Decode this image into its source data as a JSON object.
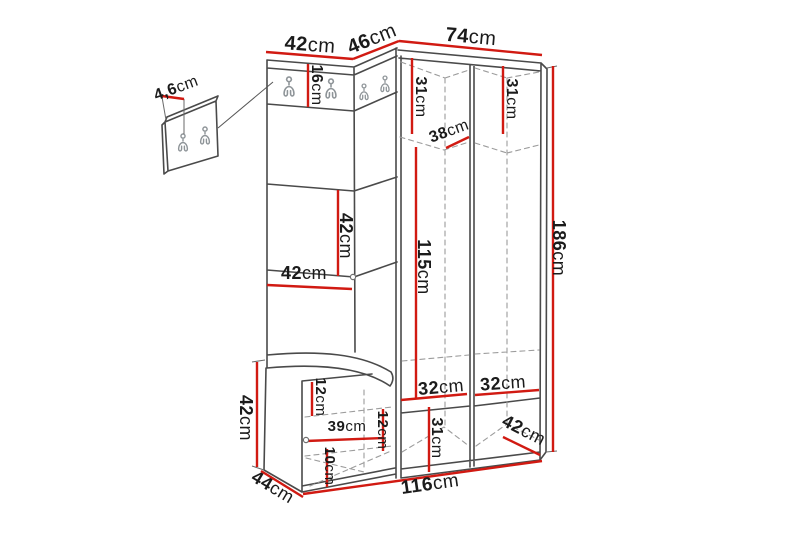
{
  "diagram": {
    "description": "Corner hallway furniture set dimension drawing with wall hook panel detail",
    "unit": "cm",
    "colors": {
      "dimension_line": "#d11a12",
      "outline": "#4a4a4a",
      "dashed": "#9c9c9c",
      "label_text": "#1b1b1b",
      "hook": "#8e9498",
      "background": "#ffffff"
    },
    "dimensions": [
      {
        "id": "top-width-left-section",
        "value": "42",
        "unit": "cm",
        "x": 310,
        "y": 45,
        "rot": 4,
        "size": 20
      },
      {
        "id": "top-width-corner-section",
        "value": "46",
        "unit": "cm",
        "x": 372,
        "y": 39,
        "rot": -22,
        "size": 20
      },
      {
        "id": "top-width-wardrobe",
        "value": "74",
        "unit": "cm",
        "x": 471,
        "y": 37,
        "rot": 5,
        "size": 20
      },
      {
        "id": "hook-panel-depth",
        "value": "4,6",
        "unit": "cm",
        "x": 176,
        "y": 88,
        "rot": -20,
        "size": 16
      },
      {
        "id": "hook-strip-height",
        "value": "16",
        "unit": "cm",
        "x": 317,
        "y": 85,
        "rot": 90,
        "size": 16
      },
      {
        "id": "top-shelf-depth-left",
        "value": "31",
        "unit": "cm",
        "x": 421,
        "y": 97,
        "rot": 90,
        "size": 16
      },
      {
        "id": "top-shelf-depth-right",
        "value": "31",
        "unit": "cm",
        "x": 512,
        "y": 99,
        "rot": 90,
        "size": 16
      },
      {
        "id": "top-shelf-width",
        "value": "38",
        "unit": "cm",
        "x": 449,
        "y": 131,
        "rot": -20,
        "size": 16
      },
      {
        "id": "hanging-space-height",
        "value": "115",
        "unit": "cm",
        "x": 424,
        "y": 267,
        "rot": 90,
        "size": 18
      },
      {
        "id": "open-shelf-section-height",
        "value": "42",
        "unit": "cm",
        "x": 346,
        "y": 236,
        "rot": 90,
        "size": 18
      },
      {
        "id": "open-shelf-width",
        "value": "42",
        "unit": "cm",
        "x": 304,
        "y": 273,
        "rot": 0,
        "size": 18
      },
      {
        "id": "bench-height",
        "value": "42",
        "unit": "cm",
        "x": 246,
        "y": 418,
        "rot": 90,
        "size": 18
      },
      {
        "id": "bench-depth",
        "value": "44",
        "unit": "cm",
        "x": 273,
        "y": 487,
        "rot": 31,
        "size": 18
      },
      {
        "id": "bench-top-section-height",
        "value": "12",
        "unit": "cm",
        "x": 321,
        "y": 397,
        "rot": 90,
        "size": 15
      },
      {
        "id": "bench-inner-width",
        "value": "39",
        "unit": "cm",
        "x": 347,
        "y": 426,
        "rot": 0,
        "size": 15
      },
      {
        "id": "bench-right-section-height",
        "value": "12",
        "unit": "cm",
        "x": 383,
        "y": 430,
        "rot": 90,
        "size": 15
      },
      {
        "id": "bench-bottom-section-height",
        "value": "10",
        "unit": "cm",
        "x": 330,
        "y": 466,
        "rot": 90,
        "size": 15
      },
      {
        "id": "wardrobe-inner-width-left",
        "value": "32",
        "unit": "cm",
        "x": 441,
        "y": 387,
        "rot": -5,
        "size": 18
      },
      {
        "id": "wardrobe-inner-width-right",
        "value": "32",
        "unit": "cm",
        "x": 503,
        "y": 383,
        "rot": -4,
        "size": 18
      },
      {
        "id": "bottom-compartment-height",
        "value": "31",
        "unit": "cm",
        "x": 437,
        "y": 438,
        "rot": 90,
        "size": 16
      },
      {
        "id": "wardrobe-depth",
        "value": "42",
        "unit": "cm",
        "x": 524,
        "y": 430,
        "rot": 27,
        "size": 18
      },
      {
        "id": "total-width",
        "value": "116",
        "unit": "cm",
        "x": 430,
        "y": 484,
        "rot": -8,
        "size": 19
      },
      {
        "id": "total-height",
        "value": "186",
        "unit": "cm",
        "x": 559,
        "y": 248,
        "rot": 90,
        "size": 18
      }
    ]
  }
}
